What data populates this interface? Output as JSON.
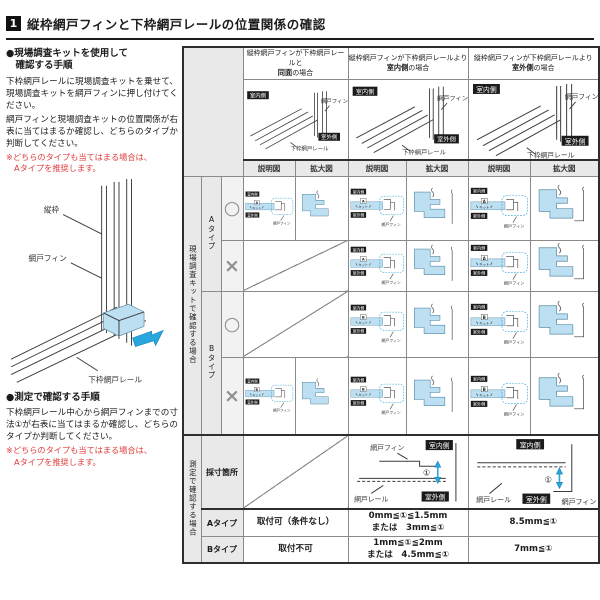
{
  "title": {
    "number": "1",
    "text": "縦枠網戸フィンと下枠網戸レールの位置関係の確認"
  },
  "left_panel": {
    "kit_section": {
      "heading_line1": "●現場調査キットを使用して",
      "heading_line2": "　確認する手順",
      "body1": "下枠網戸レールに現場調査キットを乗せて、現場調査キットを網戸フィンに押し付けてください。",
      "body2": "網戸フィンと現場調査キットの位置関係が右表に当てはまるか確認し、どちらのタイプか判断してください。",
      "note_line1": "※どちらのタイプも当てはまる場合は、",
      "note_line2": "Aタイプを推奨します。"
    },
    "measure_section": {
      "heading": "●測定で確認する手順",
      "body": "下枠網戸レール中心から網戸フィンまでの寸法①が右表に当てはまるか確認し、どちらのタイプか判断してください。",
      "note_line1": "※どちらのタイプも当てはまる場合は、",
      "note_line2": "Aタイプを推奨します。"
    },
    "diagram_labels": {
      "vertical_frame": "縦枠",
      "fin": "網戸フィン",
      "rail_full": "下枠網戸レール"
    }
  },
  "table": {
    "col_headers": [
      {
        "line1": "縦枠網戸フィンが下枠網戸レールと",
        "bold": "同面",
        "tail": "の場合"
      },
      {
        "line1": "縦枠網戸フィンが下枠網戸レールより",
        "bold": "室内側",
        "tail": "の場合"
      },
      {
        "line1": "縦枠網戸フィンが下枠網戸レールより",
        "bold": "室外側",
        "tail": "の場合"
      }
    ],
    "sub_headers": {
      "explain": "説明図",
      "enlarge": "拡大図"
    },
    "row_groups": {
      "kit_check": "現場調査キットで確認する場合",
      "measure_check": "測定で確認する場合",
      "type_a": "Aタイプ",
      "type_b": "Bタイプ",
      "ok": "○",
      "ng": "×",
      "letter_a": "A",
      "letter_b": "B"
    },
    "diagram_labels": {
      "indoor": "室内側",
      "outdoor": "室外側",
      "fin": "網戸フィン",
      "rail_full": "下枠網戸レール",
      "rail_short": "網戸レール",
      "kit": "キット",
      "dim": "①"
    },
    "bottom": {
      "measure_point": "採寸箇所",
      "row_a_label": "Aタイプ",
      "row_b_label": "Bタイプ",
      "a_c1": "取付可（条件なし）",
      "a_c2_line1": "0mm≦①≦1.5mm",
      "a_c2_line2": "または　3mm≦①",
      "a_c3": "8.5mm≦①",
      "b_c1": "取付不可",
      "b_c2_line1": "1mm≦①≦2mm",
      "b_c2_line2": "または　4.5mm≦①",
      "b_c3": "7mm≦①"
    }
  },
  "colors": {
    "blue_fill": "#bcdff2",
    "arrow_blue": "#2aa6df",
    "note_red": "#e03c3c",
    "label_bg": "#e9e9e9",
    "black_box": "#1b1b1b"
  }
}
